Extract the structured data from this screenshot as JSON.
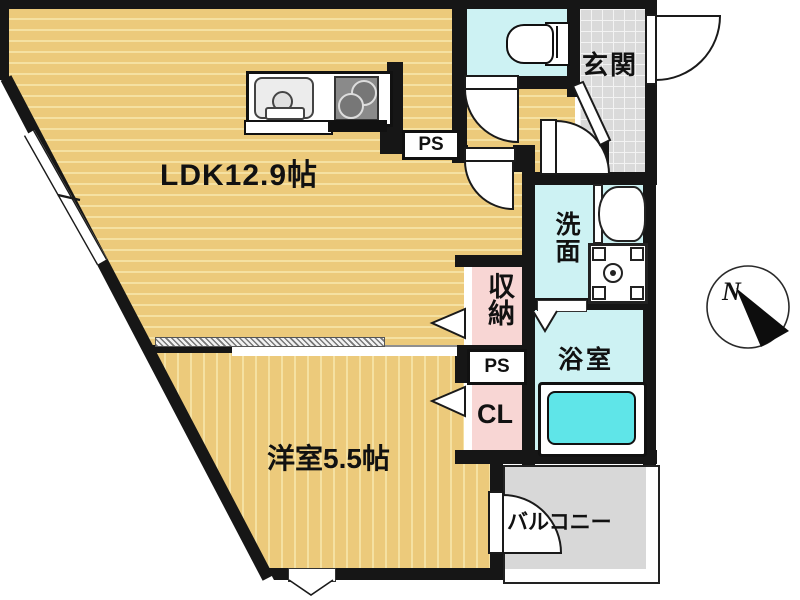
{
  "plan_title": "1LDK apartment floor plan",
  "rooms": {
    "ldk": {
      "label": "LDK12.9帖"
    },
    "western_room": {
      "label": "洋室5.5帖"
    },
    "entrance": {
      "label": "玄関"
    },
    "washroom": {
      "label": "洗面"
    },
    "bathroom": {
      "label": "浴室"
    },
    "storage": {
      "label": "収納"
    },
    "closet": {
      "label": "CL"
    },
    "pipe_space_upper": {
      "label": "PS"
    },
    "pipe_space_lower": {
      "label": "PS"
    },
    "balcony": {
      "label": "バルコニー"
    }
  },
  "compass": {
    "label": "N"
  },
  "colors": {
    "floor_wood": "#ecca7b",
    "floor_stripe": "#f5e1a2",
    "wet_room_cyan": "#cdf2f3",
    "bathtub_cyan": "#5fe5e8",
    "storage_pink": "#f8d6d4",
    "entrance_tile": "#dadada",
    "balcony_gray": "#d8d8d8",
    "wall_black": "#161616"
  }
}
